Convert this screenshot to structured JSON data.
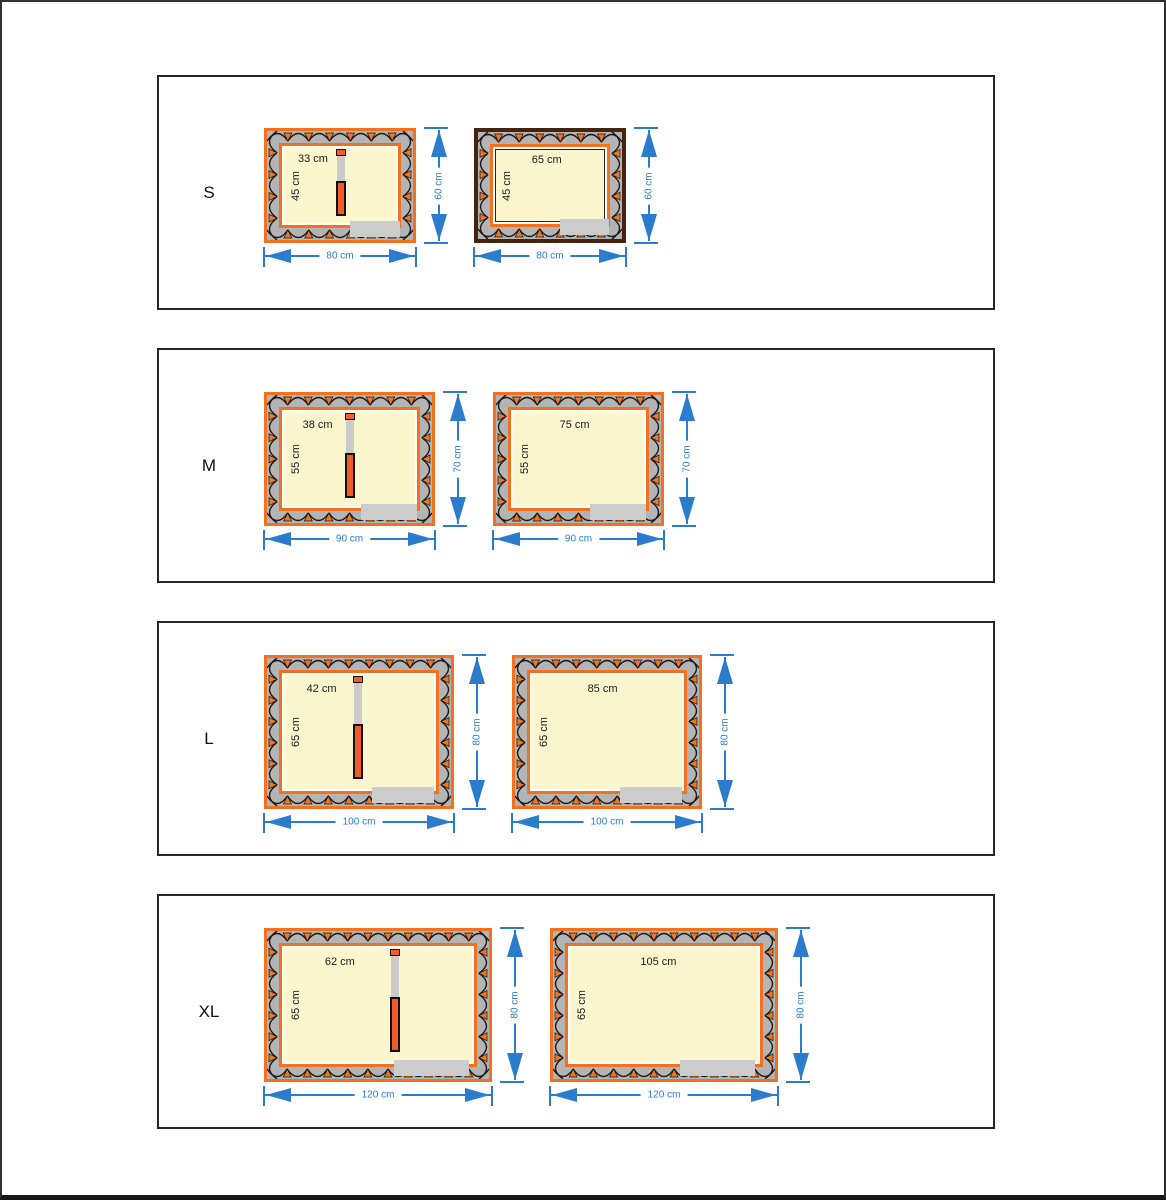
{
  "colors": {
    "orange": "#f3701e",
    "dark_brown": "#46230f",
    "divider_orange": "#f15a29",
    "blue": "#2b7ccc",
    "wall_gray": "#b4b4b4",
    "door_gray": "#cccccc",
    "cream": "#fcf6cf",
    "hatch_black": "#1b1b1b",
    "hatch_triangle": "#ee7622"
  },
  "sections": [
    {
      "label": "S",
      "plans": [
        {
          "top_label": "33 cm",
          "side_label": "45 cm",
          "width_label": "80 cm",
          "height_label": "60 cm",
          "divider": true,
          "variant": "orange"
        },
        {
          "top_label": "65 cm",
          "side_label": "45 cm",
          "width_label": "80 cm",
          "height_label": "60 cm",
          "divider": false,
          "variant": "dark"
        }
      ]
    },
    {
      "label": "M",
      "plans": [
        {
          "top_label": "38 cm",
          "side_label": "55 cm",
          "width_label": "90 cm",
          "height_label": "70 cm",
          "divider": true,
          "variant": "orange"
        },
        {
          "top_label": "75 cm",
          "side_label": "55 cm",
          "width_label": "90 cm",
          "height_label": "70 cm",
          "divider": false,
          "variant": "orange"
        }
      ]
    },
    {
      "label": "L",
      "plans": [
        {
          "top_label": "42 cm",
          "side_label": "65 cm",
          "width_label": "100 cm",
          "height_label": "80 cm",
          "divider": true,
          "variant": "orange"
        },
        {
          "top_label": "85 cm",
          "side_label": "65 cm",
          "width_label": "100 cm",
          "height_label": "80 cm",
          "divider": false,
          "variant": "orange"
        }
      ]
    },
    {
      "label": "XL",
      "plans": [
        {
          "top_label": "62 cm",
          "side_label": "65 cm",
          "width_label": "120 cm",
          "height_label": "80 cm",
          "divider": true,
          "variant": "orange"
        },
        {
          "top_label": "105 cm",
          "side_label": "65 cm",
          "width_label": "120 cm",
          "height_label": "80 cm",
          "divider": false,
          "variant": "orange"
        }
      ]
    }
  ]
}
